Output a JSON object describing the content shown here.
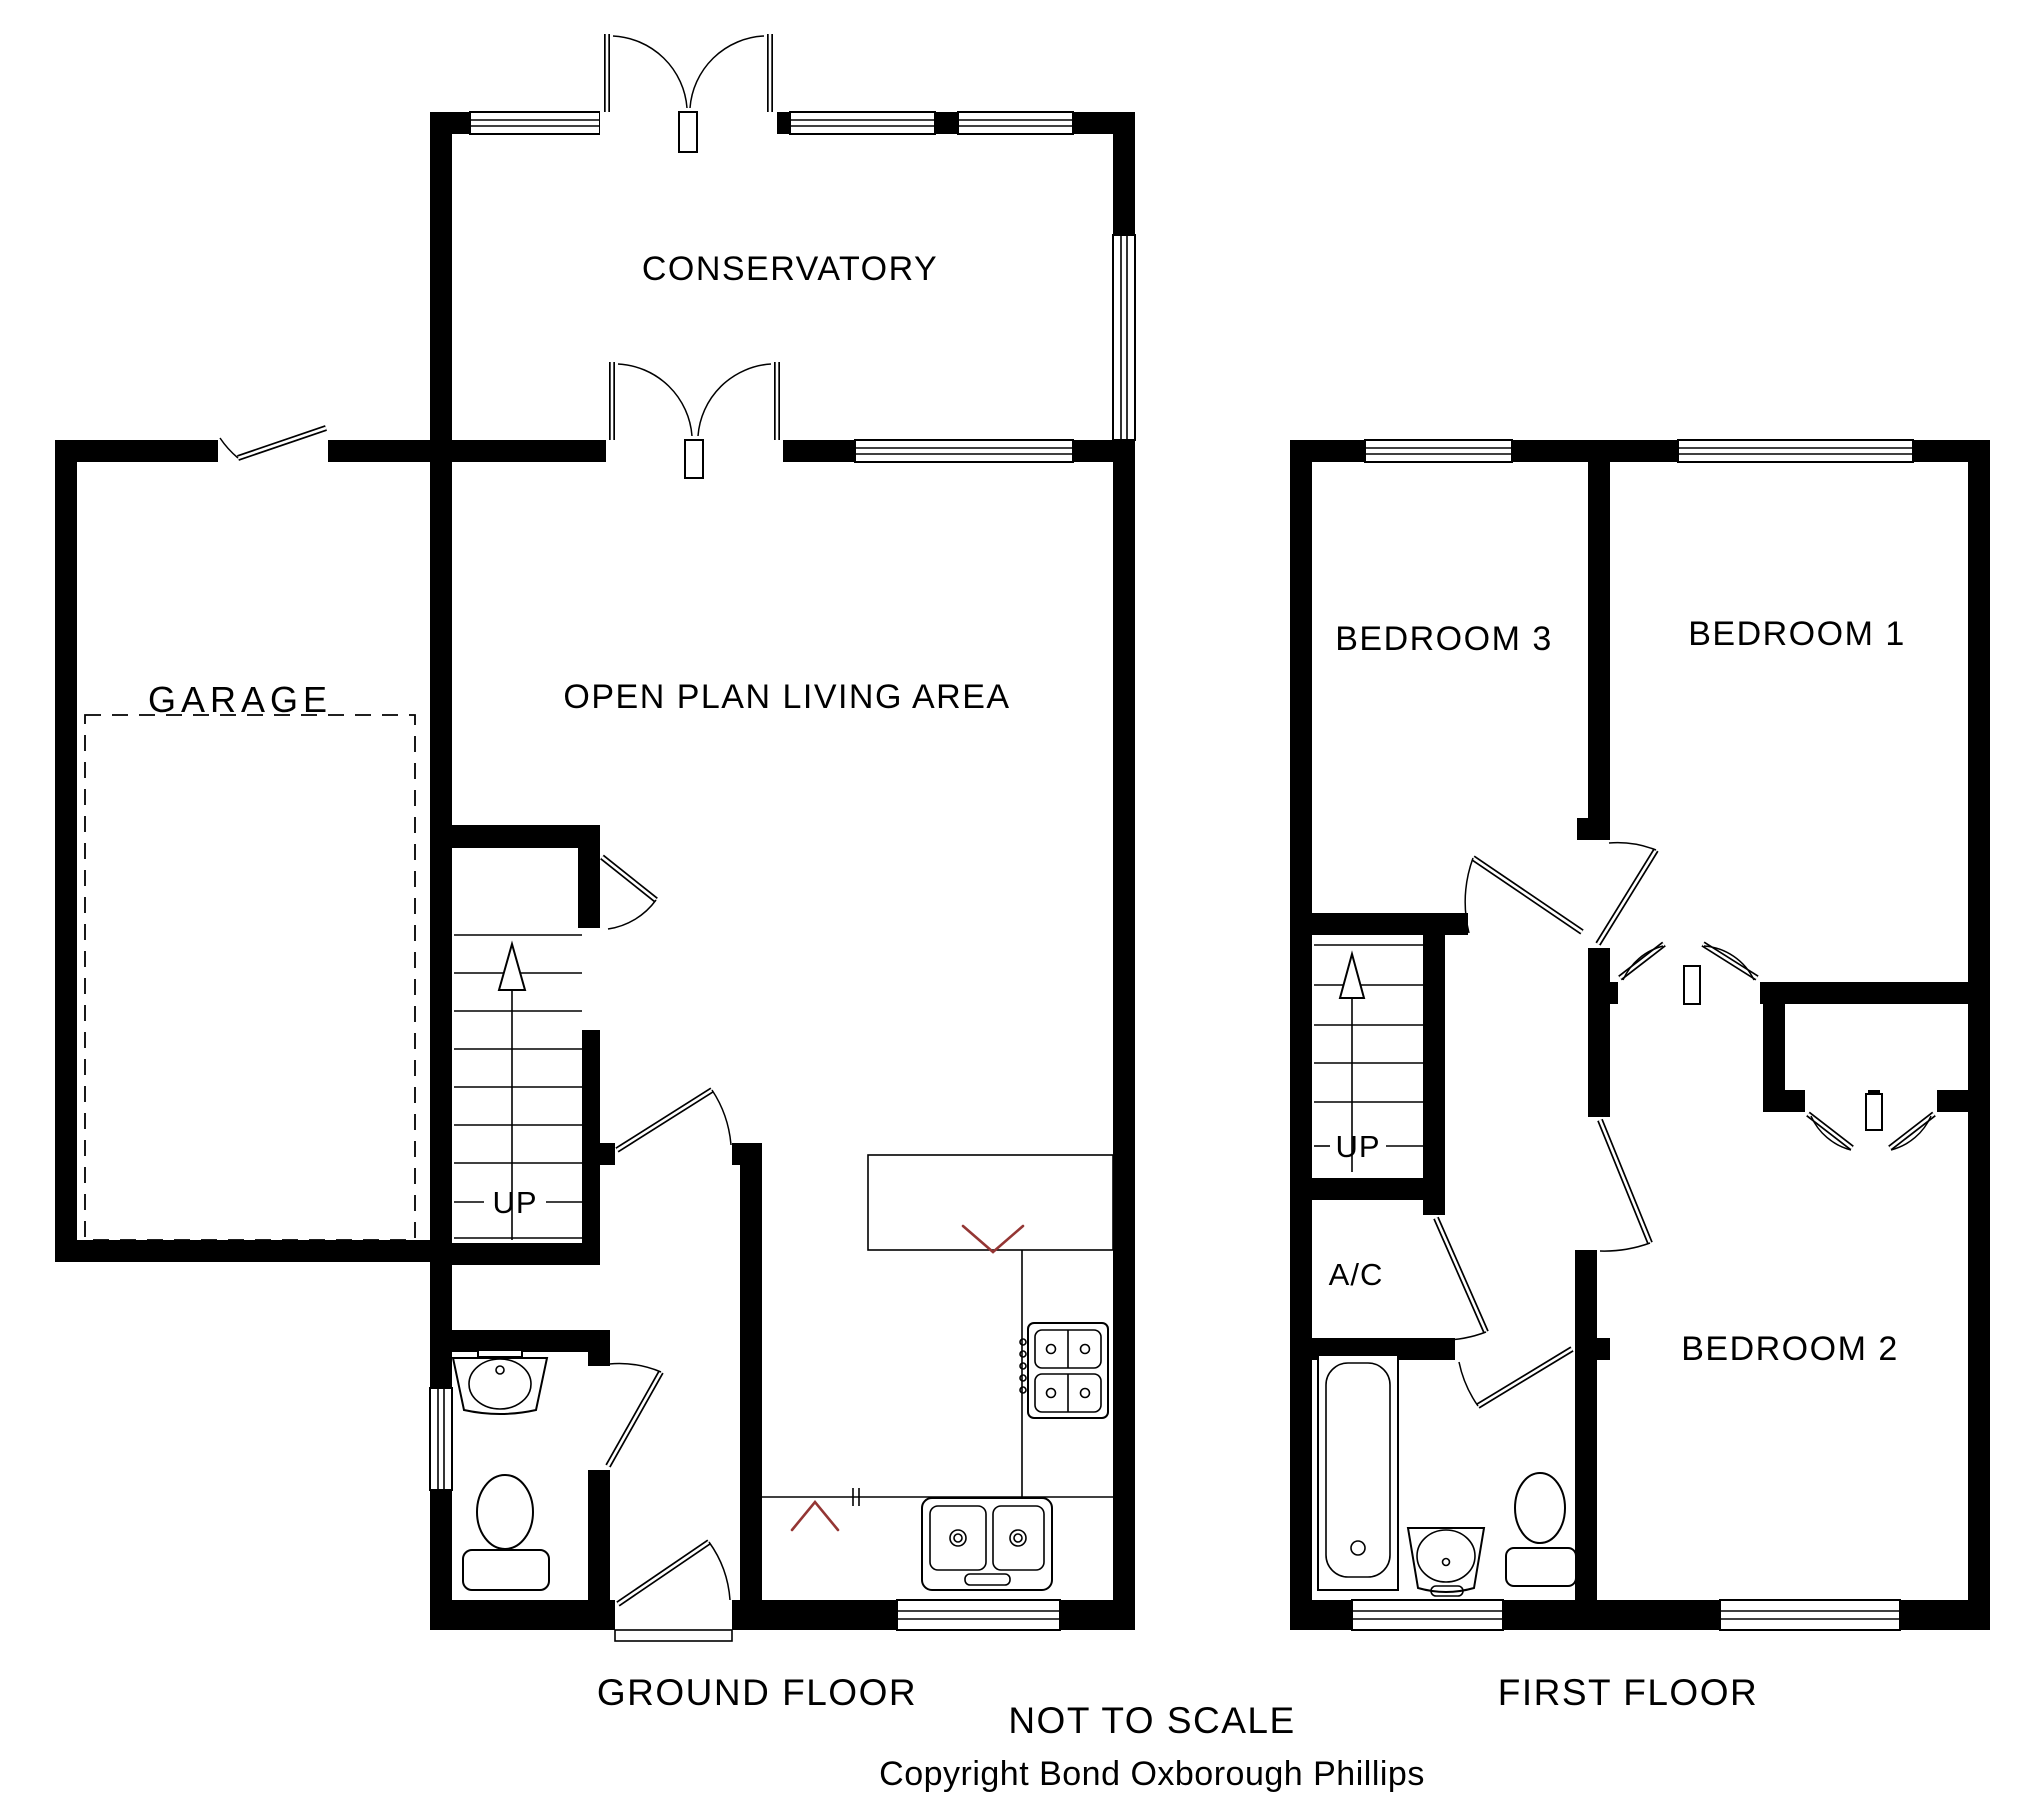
{
  "colors": {
    "wall": "#000000",
    "background": "#ffffff",
    "counter_mark_red": "#943634"
  },
  "ground_floor": {
    "title": "GROUND FLOOR",
    "rooms": {
      "conservatory": "CONSERVATORY",
      "garage": "GARAGE",
      "open_plan_living_area": "OPEN PLAN LIVING AREA"
    },
    "stairs_label": "UP"
  },
  "first_floor": {
    "title": "FIRST FLOOR",
    "rooms": {
      "bedroom1": "BEDROOM 1",
      "bedroom2": "BEDROOM 2",
      "bedroom3": "BEDROOM 3",
      "airing_cupboard": "A/C"
    },
    "stairs_label": "UP"
  },
  "footer": {
    "scale_note": "NOT TO SCALE",
    "copyright": "Copyright Bond Oxborough Phillips"
  }
}
